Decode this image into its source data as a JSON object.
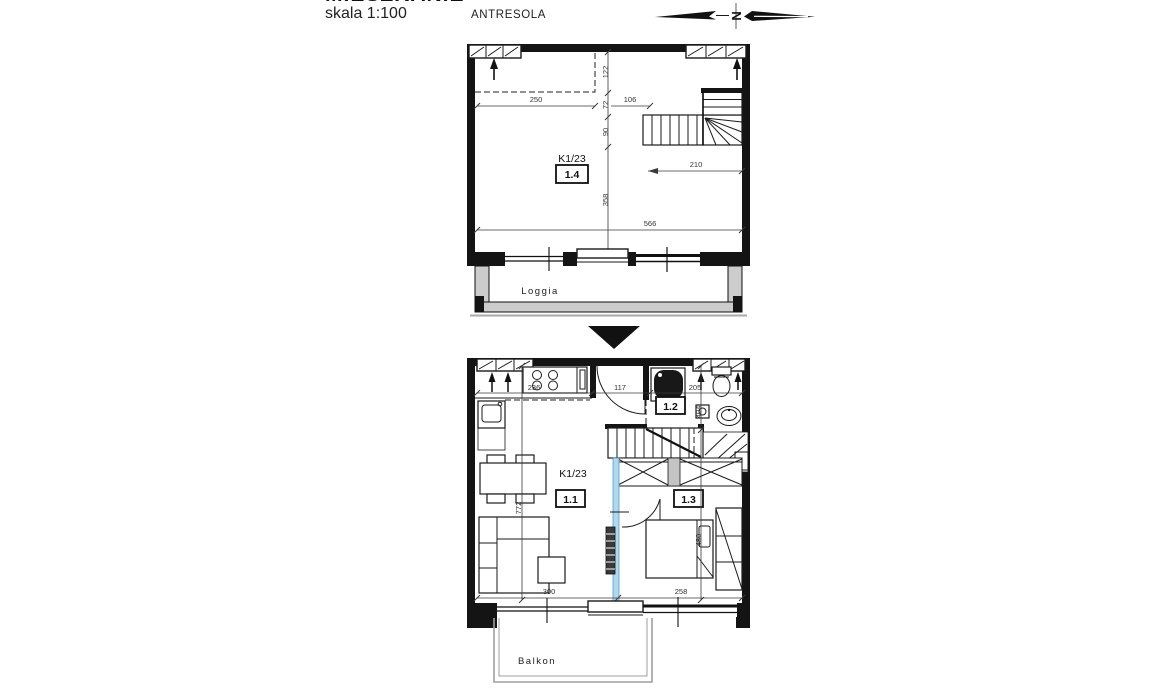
{
  "header": {
    "clipped_title": "MIESZKANIE",
    "scale_label": "skala 1:100",
    "upper_plan_label": "ANTRESOLA",
    "north_letter": "N"
  },
  "colors": {
    "wall": "#141414",
    "wall_gray": "#cccccc",
    "accent_blue": "#aed9ef",
    "dim_text": "#333333",
    "background": "#ffffff"
  },
  "upper_plan": {
    "unit_label": "K1/23",
    "room_number": "1.4",
    "loggia_label": "Loggia",
    "dims": {
      "width_left": "250",
      "width_stair": "106",
      "stair_length": "210",
      "total_width": "566",
      "h1": "122",
      "h2": "72",
      "h3": "90",
      "room_depth": "358"
    }
  },
  "lower_plan": {
    "unit_label": "K1/23",
    "room_living": "1.1",
    "room_bath": "1.2",
    "room_bedroom": "1.3",
    "balcony_label": "Balkon",
    "dims": {
      "kitchen_width": "236",
      "hall_width": "117",
      "bath_width": "205",
      "bath_depth": "404",
      "living_depth": "772",
      "bedroom_depth": "480",
      "living_width": "300",
      "bedroom_width": "258"
    }
  }
}
